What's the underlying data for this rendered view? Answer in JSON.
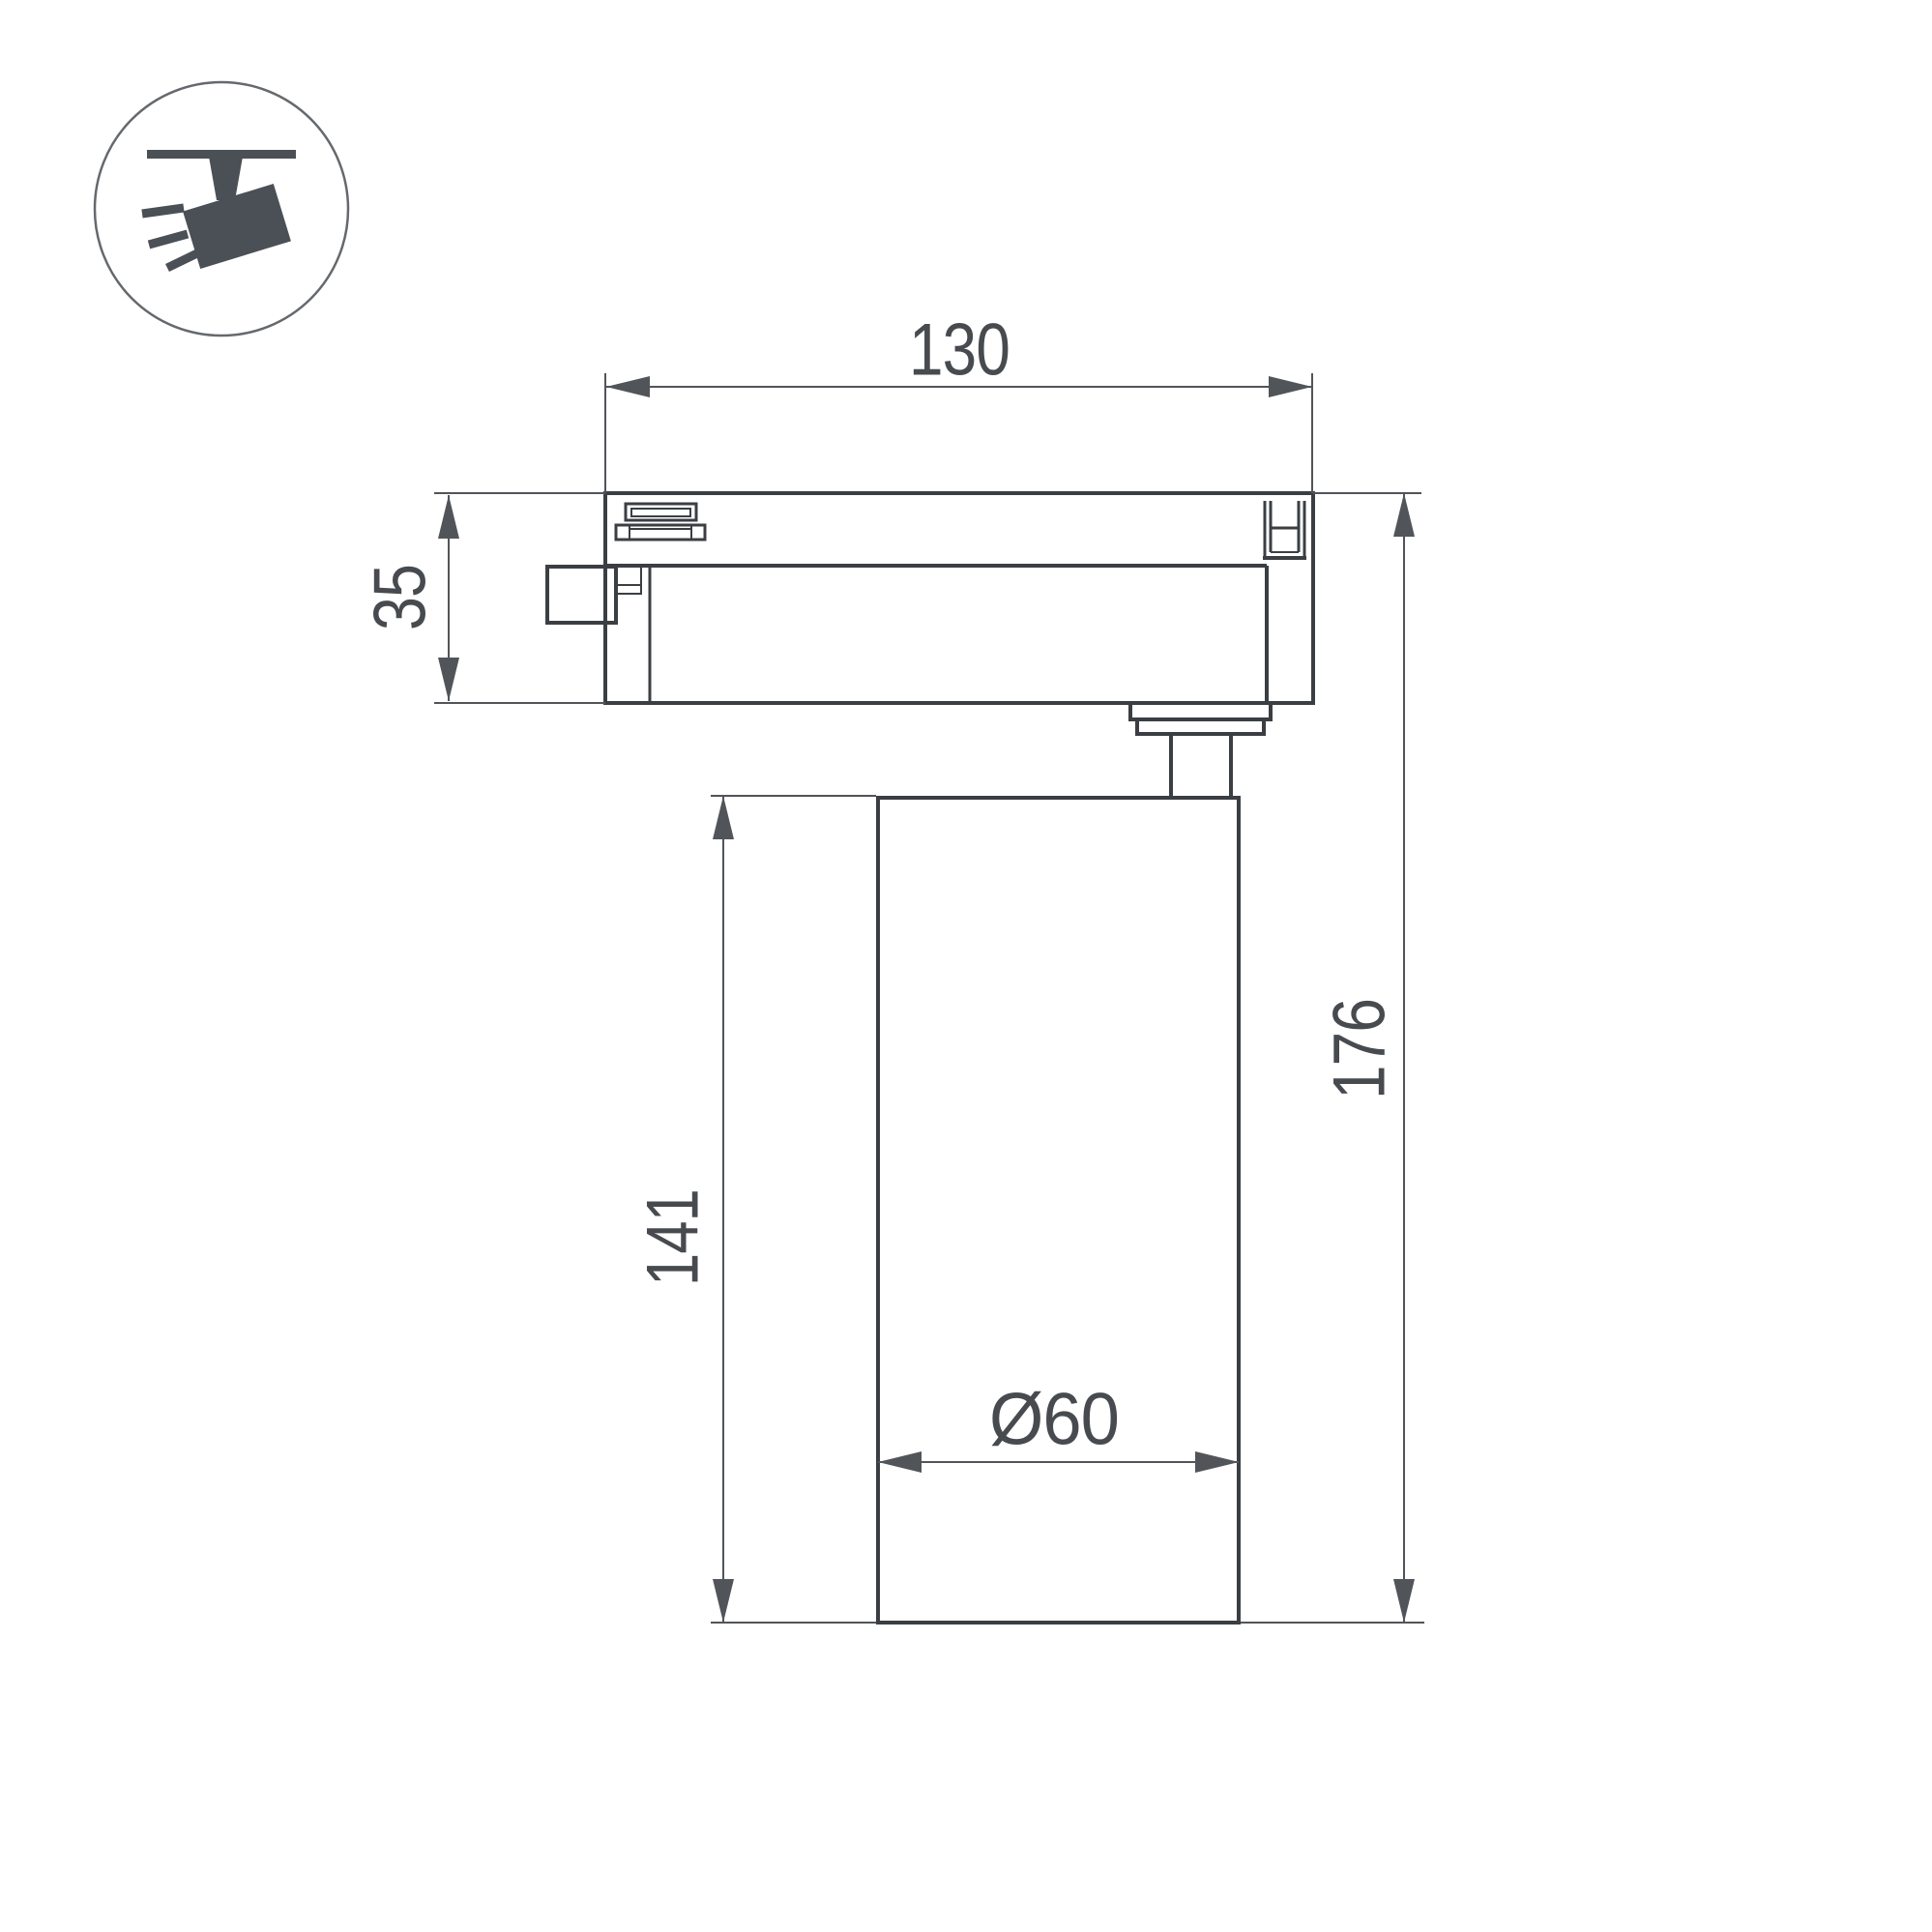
{
  "page": {
    "background": "#ffffff",
    "description": "Dimensional technical drawing of a track-mounted spotlight, side view"
  },
  "icon": {
    "name": "track-spotlight-icon",
    "depicts": "ceiling track with angled spotlight head and light rays"
  },
  "dimensions": {
    "track_width": {
      "value": "130"
    },
    "adapter_height": {
      "value": "35"
    },
    "body_height": {
      "value": "141"
    },
    "total_height": {
      "value": "176"
    },
    "body_diameter": {
      "value": "Ø60"
    }
  },
  "colors": {
    "background": "#ffffff",
    "line": "#3b3f43",
    "dim": "#515559",
    "text": "#474b4f",
    "icon": "#4a5056",
    "icon_stroke": "#65696d"
  }
}
